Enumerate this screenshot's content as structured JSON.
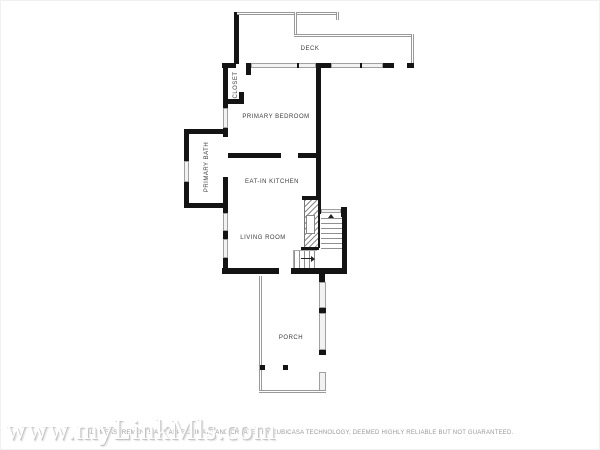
{
  "rooms": {
    "deck": {
      "label": "DECK"
    },
    "closet": {
      "label": "CLOSET"
    },
    "primary_bedroom": {
      "label": "PRIMARY BEDROOM"
    },
    "primary_bath": {
      "label": "PRIMARY BATH"
    },
    "eat_in_kitchen": {
      "label": "EAT-IN KITCHEN"
    },
    "living_room": {
      "label": "LIVING ROOM"
    },
    "porch": {
      "label": "PORCH"
    }
  },
  "footer": {
    "watermark": "www.myLinkMls.com",
    "disclaimer": "ALL MEASUREMENTS ARE APPROXIMATE AND CREATED BY CUBICASA TECHNOLOGY, DEEMED HIGHLY RELIABLE BUT NOT GUARANTEED."
  },
  "colors": {
    "background": "#ffffff",
    "wall": "#141414",
    "window_frame": "#a0a0a0",
    "railing": "#9a9a9a",
    "stair_lines": "#909090",
    "label_text": "#3c3c3c",
    "watermark_text": "#ffffff",
    "watermark_shadow": "#c4c4c4",
    "disclaimer_text": "#9a9a9a"
  }
}
